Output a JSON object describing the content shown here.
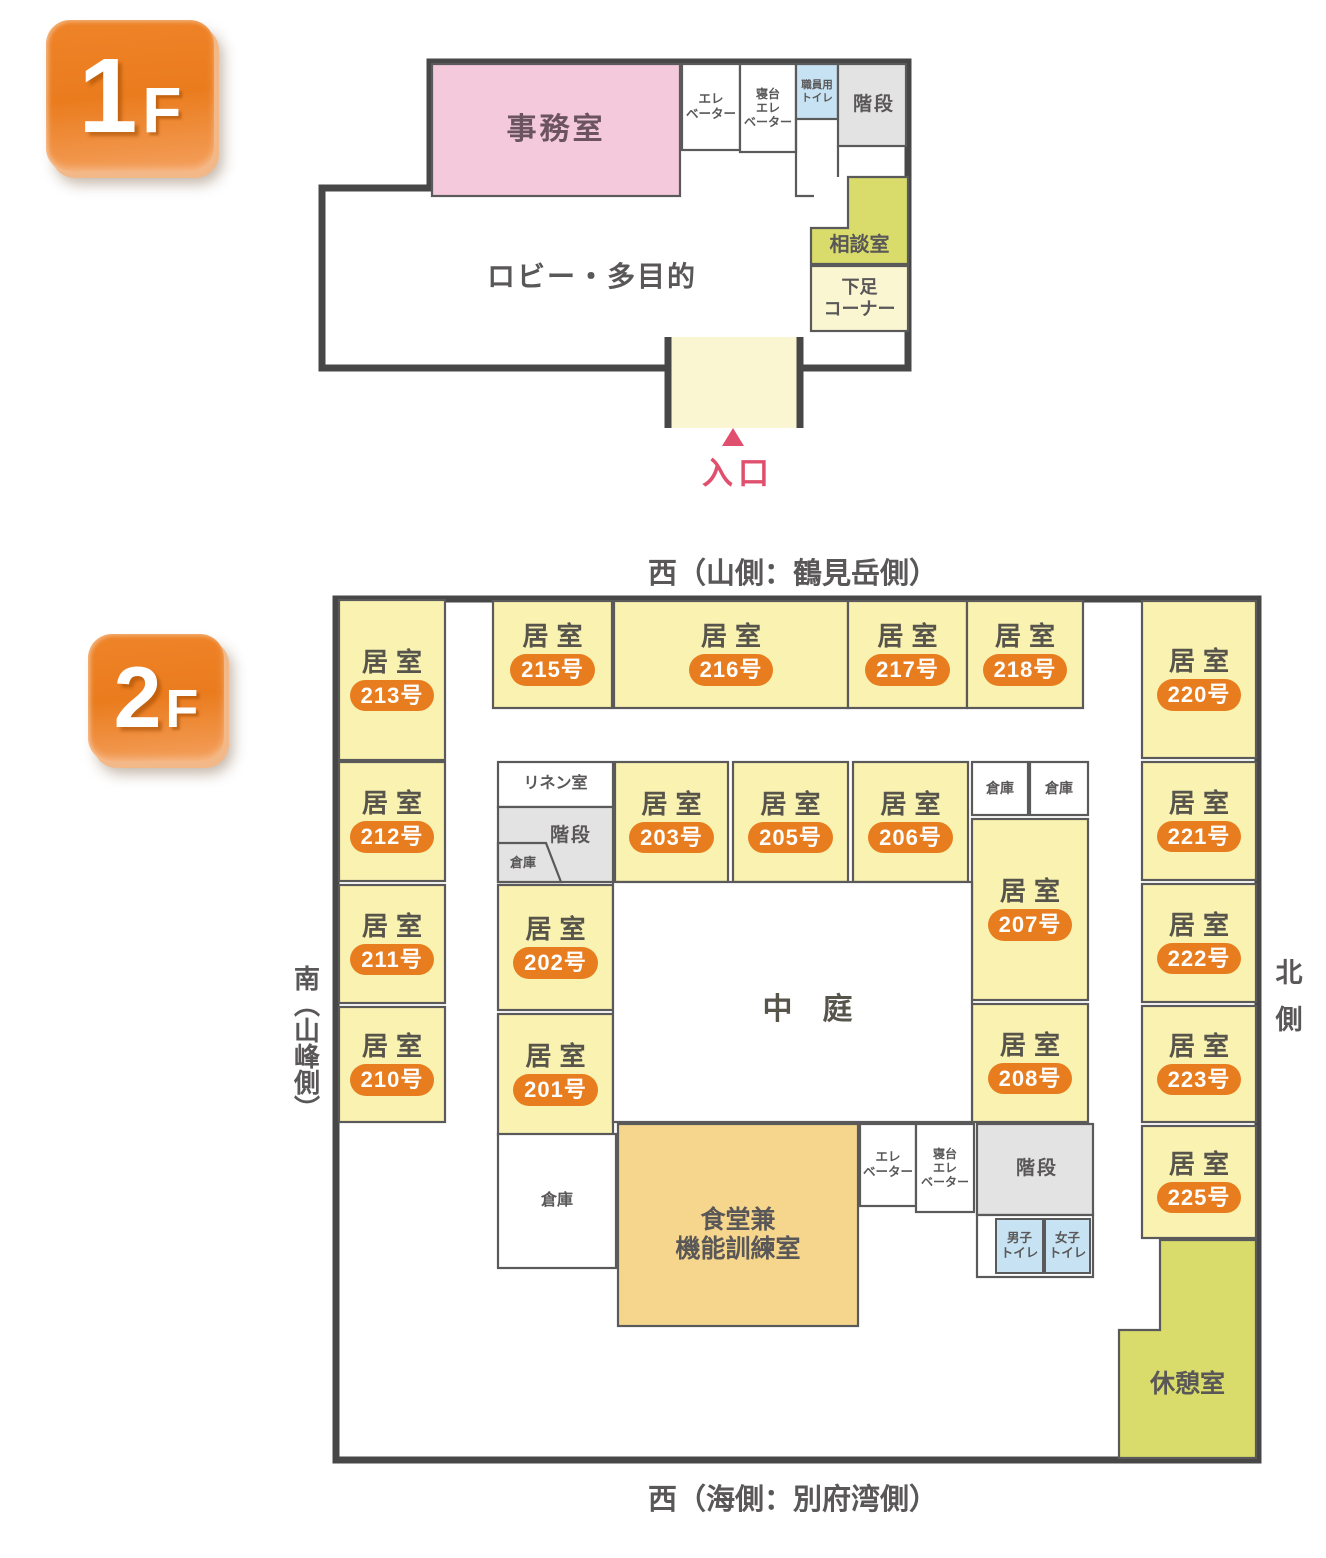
{
  "floor1": {
    "badge": {
      "number": "1",
      "suffix": "F"
    },
    "rooms": {
      "office": "事務室",
      "elevator": "エレ\nベーター",
      "bed_elevator": "寝台\nエレ\nベーター",
      "staff_toilet": "職員用\nトイレ",
      "stairs": "階段",
      "consult_room": "相談室",
      "shoe_corner": "下足\nコーナー",
      "lobby": "ロビー・多目的"
    },
    "entrance_label": "入口"
  },
  "floor2": {
    "badge": {
      "number": "2",
      "suffix": "F"
    },
    "direction_labels": {
      "top": "西（山側：鶴見岳側）",
      "bottom": "西（海側：別府湾側）",
      "left": "南（山峰側）",
      "right": "北側"
    },
    "room_word": "居室",
    "guest_rooms": [
      "213号",
      "212号",
      "211号",
      "210号",
      "215号",
      "216号",
      "217号",
      "218号",
      "220号",
      "221号",
      "222号",
      "223号",
      "225号",
      "203号",
      "205号",
      "206号",
      "202号",
      "201号",
      "207号",
      "208号"
    ],
    "rooms": {
      "linen_room": "リネン室",
      "stairs_top": "階段",
      "storage_pentagon": "倉庫",
      "storage_a": "倉庫",
      "storage_b": "倉庫",
      "courtyard": "中庭",
      "storage_bottom": "倉庫",
      "dining_training": "食堂兼\n機能訓練室",
      "elevator": "エレ\nベーター",
      "bed_elevator": "寝台\nエレ\nベーター",
      "stairs_bottom": "階段",
      "mens_toilet": "男子\nトイレ",
      "womens_toilet": "女子\nトイレ",
      "rest_room": "休憩室"
    }
  },
  "colors": {
    "wall": "#474747",
    "thin_border": "#5a5a5a",
    "room_yellow": "#FAF2B0",
    "pale_yellow": "#FBF6D2",
    "green": "#D9DC6B",
    "pink": "#F3C9DB",
    "dining_orange": "#F6D68C",
    "toilet_blue": "#C7E2F2",
    "stair_gray": "#E3E3E3",
    "number_badge_orange": "#E87D1F",
    "floor_badge_orange": "#ED7E1E",
    "text_gray": "#595757",
    "entrance_pink": "#E0506E"
  }
}
